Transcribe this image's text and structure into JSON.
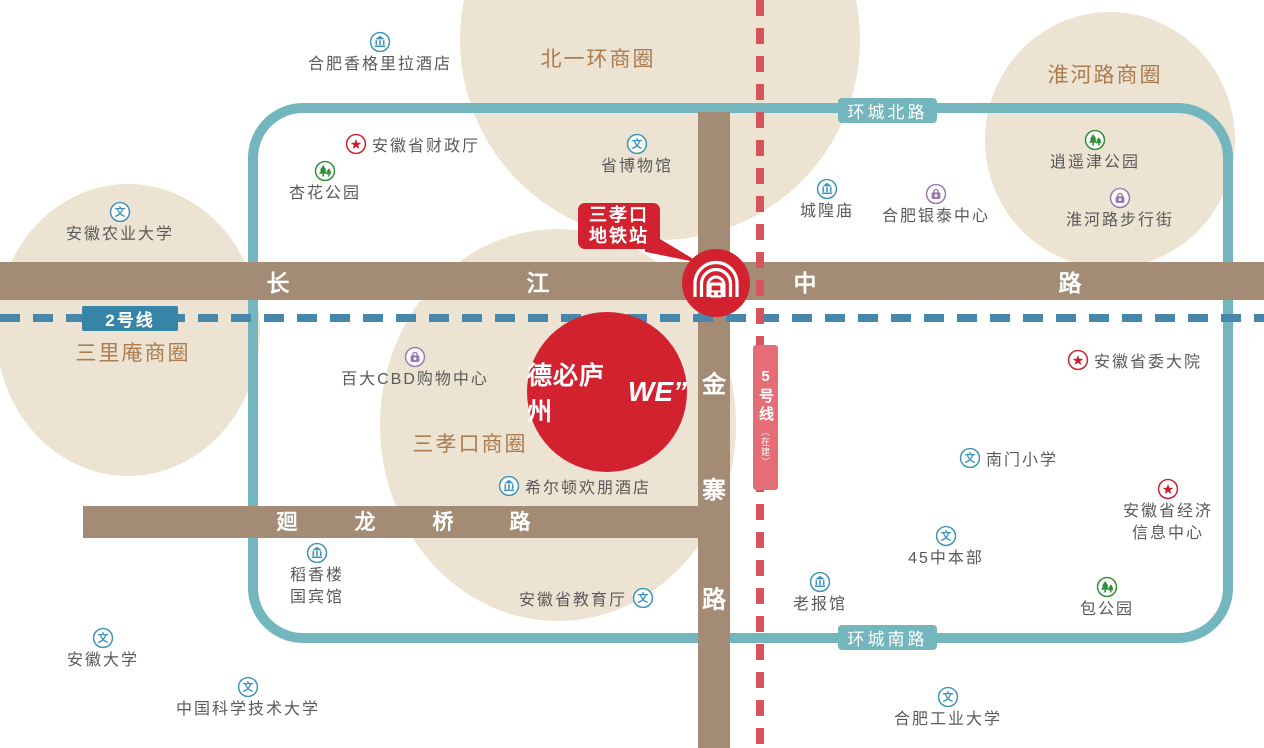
{
  "colors": {
    "blob": "#ece3d2",
    "road": "#a38b76",
    "ring": "#73b6be",
    "line2": "#4687ab",
    "line2_badge": "#3684a6",
    "line5": "#d6555d",
    "line5_badge": "#e56d75",
    "brand_red": "#d22230",
    "circle_label": "#ab7c50",
    "poi_text": "#5a5a5a",
    "icon_blue": "#3e93b8",
    "icon_green": "#2e8f36",
    "icon_purple": "#9a77b4",
    "icon_red": "#c9202c"
  },
  "business_circles": [
    {
      "label": "北一环商圈",
      "label_x": 598,
      "label_y": 58,
      "cx": 660,
      "cy": 40,
      "rx": 200,
      "ry": 200
    },
    {
      "label": "淮河路商圈",
      "label_x": 1105,
      "label_y": 74,
      "cx": 1110,
      "cy": 140,
      "rx": 125,
      "ry": 128
    },
    {
      "label": "三里庵商圈",
      "label_x": 133,
      "label_y": 352,
      "cx": 128,
      "cy": 330,
      "rx": 132,
      "ry": 146
    },
    {
      "label": "三孝口商圈",
      "label_x": 470,
      "label_y": 443,
      "cx": 558,
      "cy": 425,
      "rx": 178,
      "ry": 196
    }
  ],
  "ring_badges": {
    "north": "环城北路",
    "south": "环城南路"
  },
  "metro": {
    "line2_badge": "2号线",
    "line5_badge": "5号线",
    "line5_sub": "（在建）"
  },
  "station_bubble": {
    "line1": "三孝口",
    "line2": "地铁站"
  },
  "landmark": {
    "name_cn": "德必庐州",
    "name_en": "WE”"
  },
  "roads": [
    {
      "name": "长江中路",
      "char_size": 23,
      "chars": [
        {
          "t": "长",
          "x": 278,
          "y": 281
        },
        {
          "t": "江",
          "x": 538,
          "y": 281
        },
        {
          "t": "中",
          "x": 805,
          "y": 281
        },
        {
          "t": "路",
          "x": 1070,
          "y": 281
        }
      ]
    },
    {
      "name": "金寨路",
      "char_size": 24,
      "chars": [
        {
          "t": "金",
          "x": 714,
          "y": 382
        },
        {
          "t": "寨",
          "x": 714,
          "y": 488
        },
        {
          "t": "路",
          "x": 714,
          "y": 597
        }
      ]
    },
    {
      "name": "廻龙桥路",
      "char_size": 21,
      "chars": [
        {
          "t": "廻",
          "x": 287,
          "y": 521
        },
        {
          "t": "龙",
          "x": 365,
          "y": 521
        },
        {
          "t": "桥",
          "x": 443,
          "y": 521
        },
        {
          "t": "路",
          "x": 520,
          "y": 521
        }
      ]
    }
  ],
  "pois": [
    {
      "label": "合肥香格里拉酒店",
      "icon": "bank",
      "color": "blue",
      "x": 380,
      "y": 42,
      "layout": "below"
    },
    {
      "label": "安徽省财政厅",
      "icon": "star",
      "color": "red",
      "x": 356,
      "y": 144,
      "layout": "right"
    },
    {
      "label": "杏花公园",
      "icon": "tree",
      "color": "green",
      "x": 325,
      "y": 171,
      "layout": "below"
    },
    {
      "label": "省博物馆",
      "icon": "culture",
      "color": "blue",
      "x": 637,
      "y": 144,
      "layout": "below"
    },
    {
      "label": "逍遥津公园",
      "icon": "tree",
      "color": "green",
      "x": 1095,
      "y": 140,
      "layout": "below"
    },
    {
      "label": "城隍庙",
      "icon": "bank",
      "color": "blue",
      "x": 827,
      "y": 189,
      "layout": "below"
    },
    {
      "label": "合肥银泰中心",
      "icon": "bag",
      "color": "purple",
      "x": 936,
      "y": 194,
      "layout": "below"
    },
    {
      "label": "淮河路步行街",
      "icon": "bag",
      "color": "purple",
      "x": 1120,
      "y": 198,
      "layout": "below"
    },
    {
      "label": "安徽农业大学",
      "icon": "culture",
      "color": "blue",
      "x": 120,
      "y": 212,
      "layout": "below"
    },
    {
      "label": "百大CBD购物中心",
      "icon": "bag",
      "color": "purple",
      "x": 415,
      "y": 357,
      "layout": "below"
    },
    {
      "label": "安徽省委大院",
      "icon": "star",
      "color": "red",
      "x": 1078,
      "y": 360,
      "layout": "right"
    },
    {
      "label": "南门小学",
      "icon": "culture",
      "color": "blue",
      "x": 970,
      "y": 458,
      "layout": "right"
    },
    {
      "label": "希尔顿欢朋酒店",
      "icon": "bank",
      "color": "blue",
      "x": 509,
      "y": 486,
      "layout": "right"
    },
    {
      "label": "安徽省经济",
      "label2": "信息中心",
      "icon": "star",
      "color": "red",
      "x": 1168,
      "y": 489,
      "layout": "below"
    },
    {
      "label": "45中本部",
      "icon": "culture",
      "color": "blue",
      "x": 946,
      "y": 536,
      "layout": "below"
    },
    {
      "label": "稻香楼",
      "label2": "国宾馆",
      "icon": "bank",
      "color": "blue",
      "x": 317,
      "y": 553,
      "layout": "below"
    },
    {
      "label": "安徽省教育厅",
      "icon": "culture",
      "color": "blue",
      "x": 643,
      "y": 598,
      "layout": "left"
    },
    {
      "label": "老报馆",
      "icon": "bank",
      "color": "blue",
      "x": 820,
      "y": 582,
      "layout": "below"
    },
    {
      "label": "包公园",
      "icon": "tree",
      "color": "green",
      "x": 1107,
      "y": 587,
      "layout": "below"
    },
    {
      "label": "安徽大学",
      "icon": "culture",
      "color": "blue",
      "x": 103,
      "y": 638,
      "layout": "below"
    },
    {
      "label": "中国科学技术大学",
      "icon": "culture",
      "color": "blue",
      "x": 248,
      "y": 687,
      "layout": "below"
    },
    {
      "label": "合肥工业大学",
      "icon": "culture",
      "color": "blue",
      "x": 948,
      "y": 697,
      "layout": "below"
    }
  ]
}
